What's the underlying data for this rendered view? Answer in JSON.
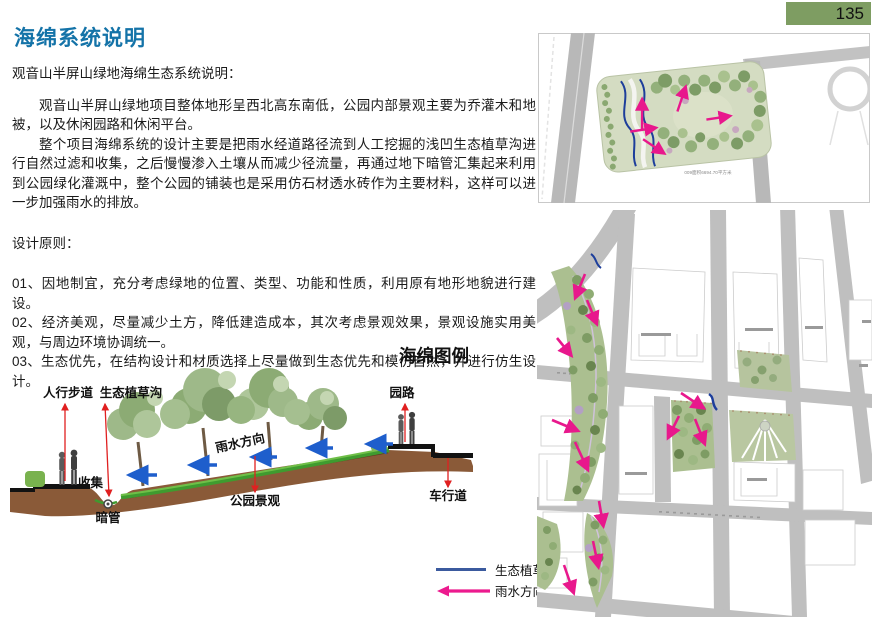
{
  "page_number": "135",
  "title": "海绵系统说明",
  "body": {
    "intro": "观音山半屏山绿地海绵生态系统说明：",
    "para1": "观音山半屏山绿地项目整体地形呈西北高东南低，公园内部景观主要为乔灌木和地被，以及休闲园路和休闲平台。",
    "para2": "整个项目海绵系统的设计主要是把雨水经道路径流到人工挖掘的浅凹生态植草沟进行自然过滤和收集，之后慢慢渗入土壤从而减少径流量，再通过地下暗管汇集起来利用到公园绿化灌溉中，整个公园的铺装也是采用仿石材透水砖作为主要材料，这样可以进一步加强雨水的排放。",
    "principles_heading": "设计原则：",
    "principles": [
      "01、因地制宜，充分考虑绿地的位置、类型、功能和性质，利用原有地形地貌进行建设。",
      "02、经济美观，尽量减少土方，降低建造成本，其次考虑景观效果，景观设施实用美观，与周边环境协调统一。",
      "03、生态优先，在结构设计和材质选择上尽量做到生态优先和模仿自然，并进行仿生设计。"
    ]
  },
  "diagram": {
    "title": "海绵图例",
    "labels": {
      "walkway": "人行步道",
      "swale": "生态植草沟",
      "collect": "收集",
      "pipe": "暗管",
      "rain_direction": "雨水方向",
      "park_view": "公园景观",
      "park_road": "园路",
      "vehicle_road": "车行道"
    }
  },
  "legend": {
    "swale": "生态植草沟",
    "rain_direction": "雨水方向"
  },
  "maps": {
    "top_caption": "009面积6694.70平方米"
  },
  "colors": {
    "title_blue": "#1473a8",
    "badge_green": "#7e9d62",
    "arrow_pink": "#e8188c",
    "arrow_blue": "#1e5ecc",
    "arrow_red": "#e02020",
    "swale_blue": "#1d3e9b"
  }
}
